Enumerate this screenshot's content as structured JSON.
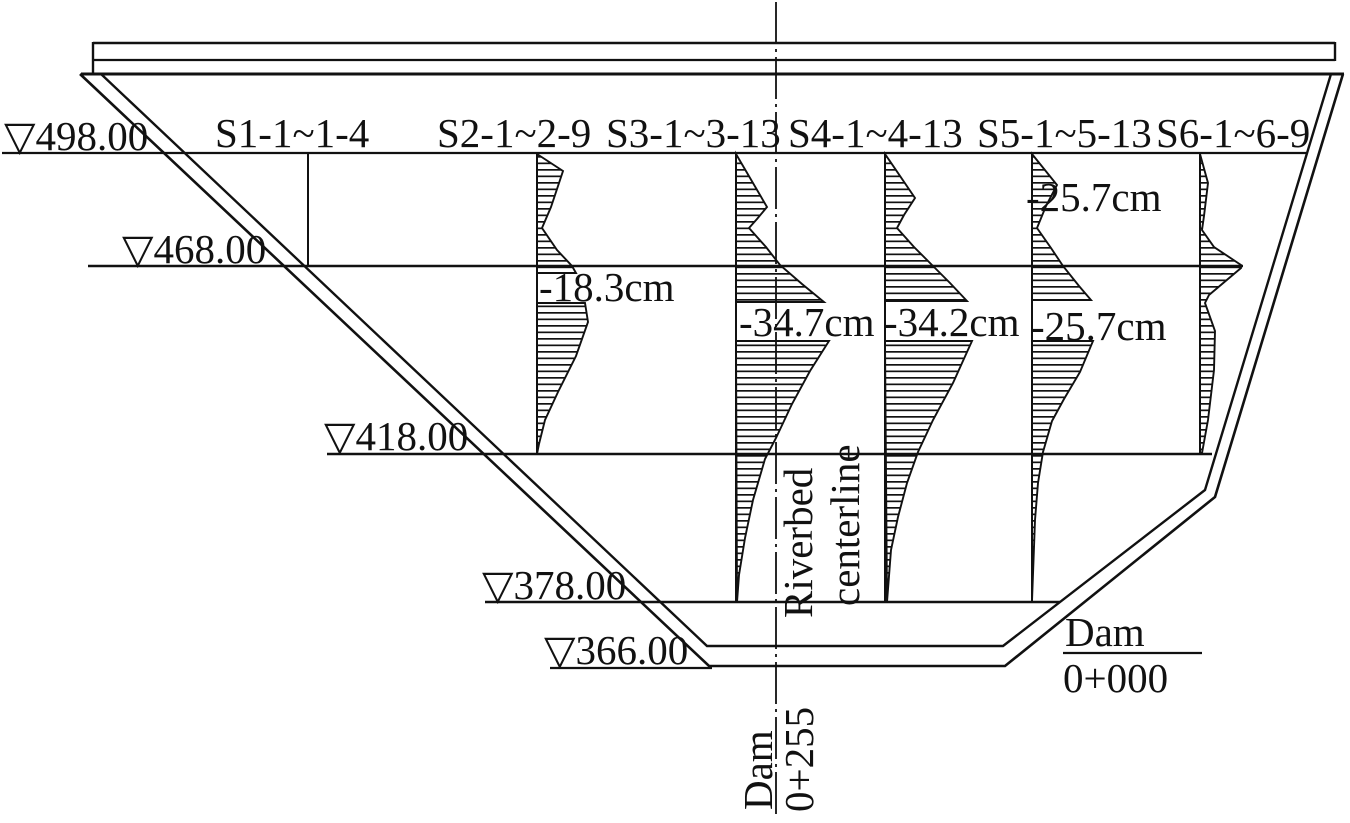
{
  "sections": [
    {
      "id": "S1",
      "label": "S1-1~1-4"
    },
    {
      "id": "S2",
      "label": "S2-1~2-9",
      "max_settlement": "-18.3cm"
    },
    {
      "id": "S3",
      "label": "S3-1~3-13",
      "max_settlement": "-34.7cm"
    },
    {
      "id": "S4",
      "label": "S4-1~4-13",
      "max_settlement": "-34.2cm"
    },
    {
      "id": "S5",
      "label": "S5-1~5-13",
      "settlement_upper": "-25.7cm",
      "max_settlement": "-25.7cm"
    },
    {
      "id": "S6",
      "label": "S6-1~6-9"
    }
  ],
  "elevation_markers": [
    {
      "value": "498.00",
      "label": "▽498.00"
    },
    {
      "value": "468.00",
      "label": "▽468.00"
    },
    {
      "value": "418.00",
      "label": "▽418.00"
    },
    {
      "value": "378.00",
      "label": "▽378.00"
    },
    {
      "value": "366.00",
      "label": "▽366.00"
    }
  ],
  "riverbed_centerline": {
    "line1": "Riverbed",
    "line2": "centerline"
  },
  "stations": {
    "center": {
      "name": "Dam",
      "value": "0+255"
    },
    "downstream": {
      "name": "Dam",
      "value": "0+000"
    }
  },
  "colors": {
    "ink": "#111111",
    "background": "#ffffff"
  }
}
